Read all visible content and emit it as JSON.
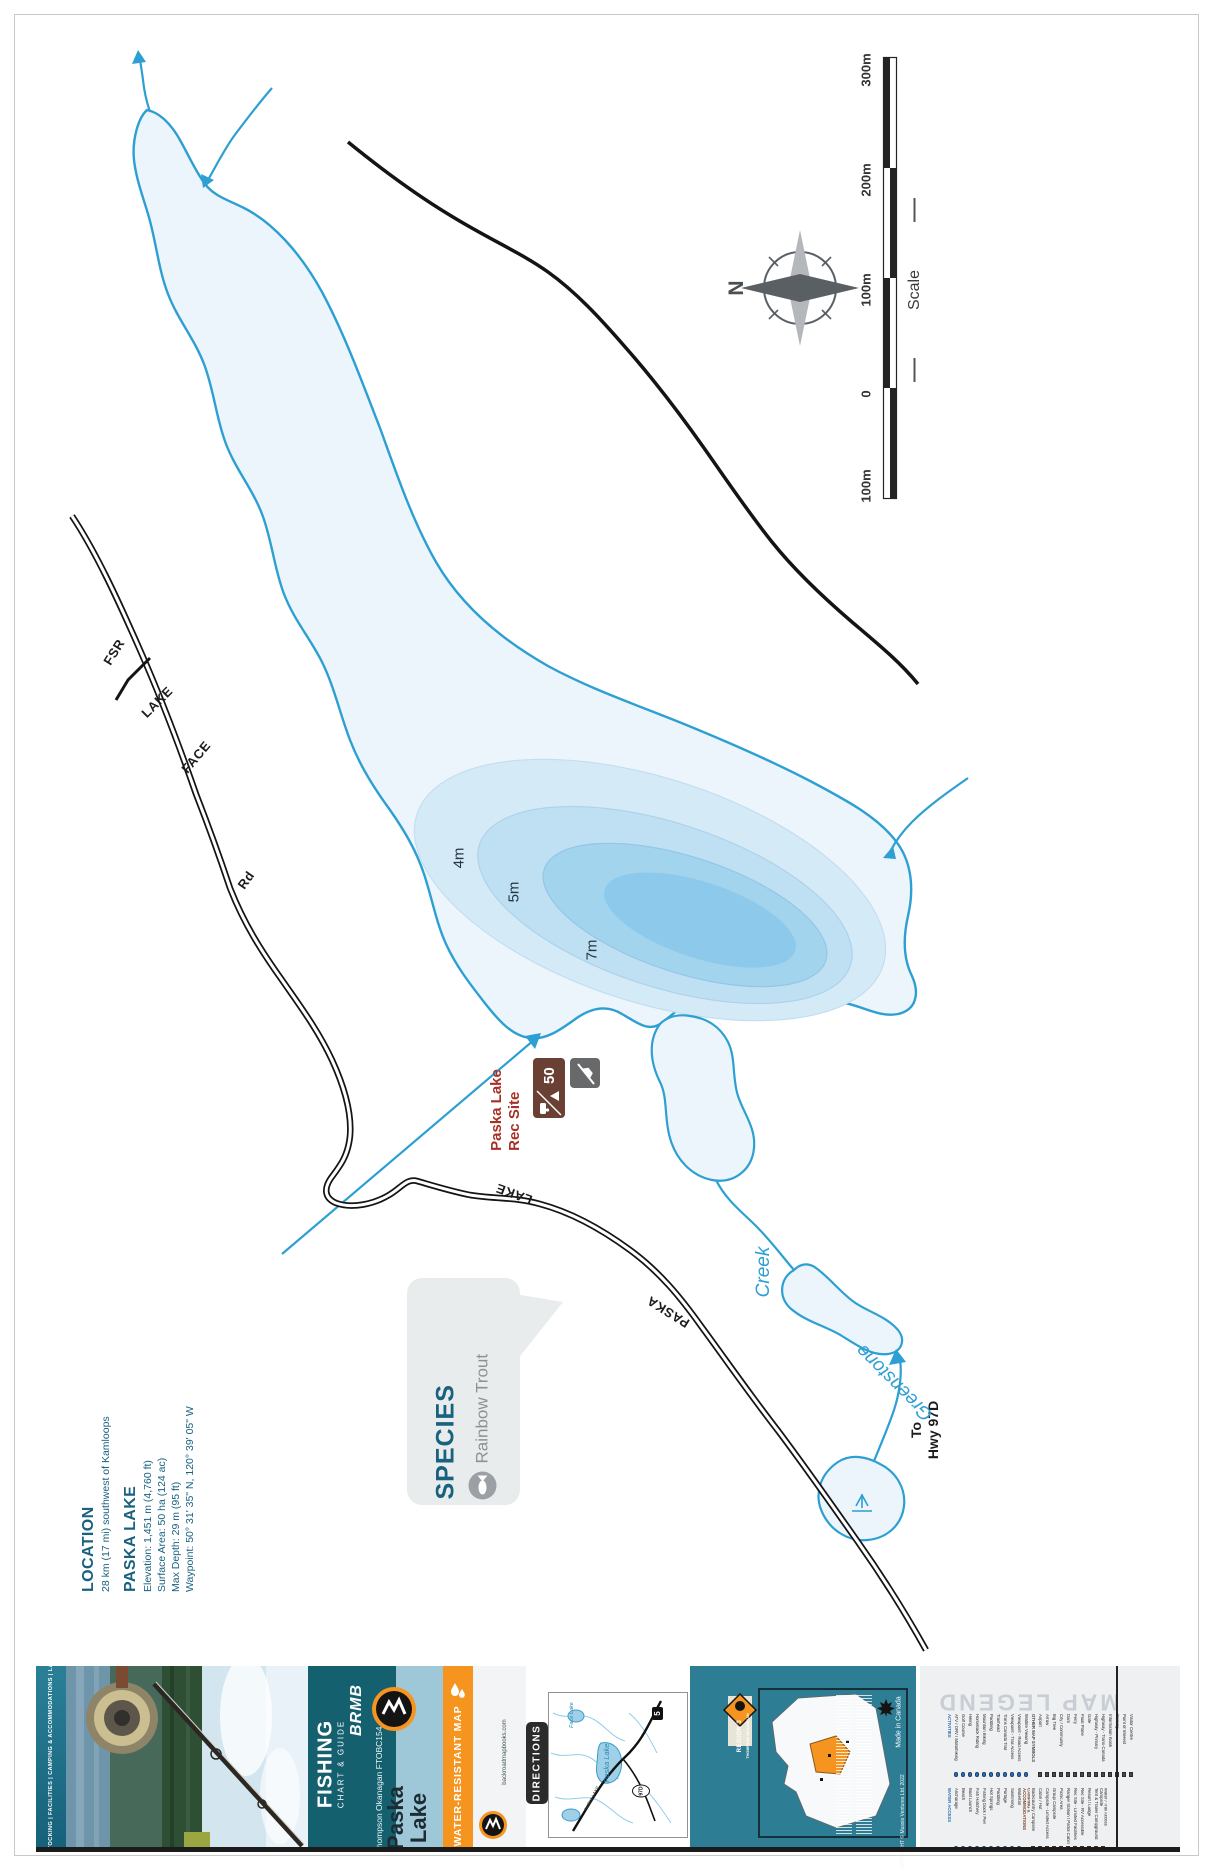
{
  "map": {
    "compass_n": "N",
    "scale": {
      "label": "Scale",
      "ticks": [
        "300m",
        "200m",
        "100m",
        "0",
        "100m"
      ]
    },
    "depth_labels": [
      "4m",
      "5m",
      "7m"
    ],
    "roads": {
      "face": "FACE",
      "lake1": "LAKE",
      "fsr": "FSR",
      "rd": "Rd",
      "paska": "PASKA",
      "lake2": "LAKE",
      "to_line1": "To",
      "to_line2": "Hwy 97D"
    },
    "water": {
      "greenstone": "Greenstone",
      "creek": "Creek"
    },
    "rec_site": {
      "line1": "Paska Lake",
      "line2": "Rec  Site",
      "capacity": "50"
    }
  },
  "info": {
    "location_heading": "LOCATION",
    "location_text": "28 km (17 mi) southwest of Kamloops",
    "lake_heading": "PASKA LAKE",
    "stats": [
      "Elevation: 1,451 m (4,760 ft)",
      "Surface Area: 50 ha (124 ac)",
      "Max Depth: 29 m (95 ft)",
      "Waypoint: 50° 31' 35\" N, 120° 39' 05\" W"
    ]
  },
  "species": {
    "heading": "SPECIES",
    "value": "Rainbow Trout"
  },
  "cover": {
    "slogan": "FISHING HOT SPOTS  |  SPECIES & STOCKING  |  FACILITIES  |  CAMPING & ACCOMMODATIONS  |  LAKE BATHYMETRY  |  DIRECTIONS",
    "tear_resistant": "Tear-Resistant",
    "brand": "BRMB",
    "product": "FISHING",
    "product_sub": "CHART & GUIDE",
    "series": "Thompson Okanagan FTOBC154",
    "map_name_line1": "Paska",
    "map_name_line2": "Lake",
    "banner": "WATER-RESISTANT MAP",
    "website": "backroadmapbooks.com",
    "directions": "DIRECTIONS",
    "inset": {
      "lake1": "Paska Lake",
      "lake2": "Face Lake",
      "shield1": "5",
      "shield2": "97D",
      "road": "PASKA LAKE"
    },
    "region_line1": "REGION 3",
    "region_line2": "THOMPSON OKANAGAN",
    "made_in": "Made in Canada",
    "copyright": "COPYRIGHT © Mussio Ventures Ltd. 2022"
  },
  "legend": {
    "title": "MAP LEGEND",
    "bands": [
      [
        {
          "heading": "ACTIVITIES",
          "color": "#2f6fb5",
          "round": true,
          "items": [
            "ATV / ORV / Motorbiking",
            "Golf Course",
            "Hiking",
            "Horseback Riding",
            "Mountain Biking",
            "Paddling",
            "Trailhead",
            "Trans Canada Trail",
            "Viewpoint - Trail Access",
            "Viewpoint - Road Access",
            "Wildlife Viewing"
          ]
        },
        {
          "heading": "OTHER MAP SYMBOLS",
          "color": "#4a4a4a",
          "round": false,
          "items": [
            "Airport",
            "Arrow",
            "Big Tree",
            "City / Community",
            "Dam",
            "Ferry",
            "Float Plane",
            "Gate",
            "Highway - Primary",
            "Highway - Trans-Canada",
            "Information Kiosk",
            "Parking",
            "Point of Interest",
            "Visitor Centre"
          ]
        }
      ],
      [
        {
          "heading": "WATER ACCESS",
          "color": "#2f6fb5",
          "round": true,
          "items": [
            "Anchorage",
            "Beach",
            "Boat Launch",
            "Fish Hatchery",
            "Fishing Dock / Pier",
            "Hot Springs",
            "Paddling",
            "Portage",
            "Swimming",
            "Waterfall"
          ]
        },
        {
          "heading": "CAMPING & ACCOMMODATIONS",
          "color": "#7d4a33",
          "round": false,
          "items": [
            "Backcountry Campsite",
            "Cabin / Hut",
            "Campsite - Limited Access",
            "Group Campsite",
            "Picnic Area",
            "Ranger Station / Patrol Cabin",
            "Rec Site - Limited Facilities",
            "Rec Site - RV Accessible",
            "Resort / Lodge",
            "Tent & Trailer Campground",
            "Water / Trail Access Campsite"
          ]
        }
      ]
    ]
  },
  "colors": {
    "water_line": "#2d9fd2",
    "lake_fill": "#ecf5fb",
    "depth_4m": "#d5eaf7",
    "depth_5m": "#bfe0f3",
    "depth_7m": "#a3d4ee",
    "depth_max": "#8cc9ea",
    "rec_red": "#a63127",
    "heading_teal": "#19617f",
    "cover_teal": "#15606f",
    "cover_orange": "#f5941f",
    "road_black": "#141414"
  }
}
